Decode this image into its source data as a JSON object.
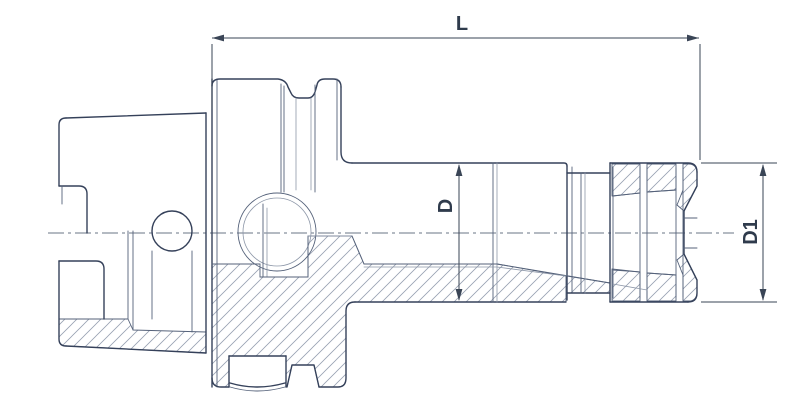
{
  "figure": {
    "type": "technical-drawing",
    "description": "Cross-section side view of an HSK shank collet chuck tool holder with dimension callouts",
    "background": "#ffffff"
  },
  "colors": {
    "outline": "#35415a",
    "detail": "#55627a",
    "thin": "#8d97a8",
    "dimension": "#3a4556",
    "centerline": "#6a7486",
    "hatch": "#98a1b2",
    "label_text": "#2f3b4c"
  },
  "labels": {
    "length": "L",
    "diameter": "D",
    "diameter1": "D1"
  },
  "drawing": {
    "width": 812,
    "height": 408,
    "elements": [
      {
        "name": "hatch-shank-wall",
        "kind": "path",
        "cls": "hatch",
        "d": "M59,319 L128,319 L133,330 L206,332 L206,353 L66,346 Q59,345 59,339 Z"
      },
      {
        "name": "hatch-flange-body",
        "kind": "path",
        "cls": "hatch",
        "d": "M212,264 L260,264 L260,277 L308,277 L308,236 L352,236 L364,264 L497,264 L566,276 L566,302 L354,302 Q346,302 346,311 L346,378 Q346,387 337,387 L319,387 L314,365 L292,365 L287,387 L286,387 L286,356 L229,356 L229,387 L221,387 Q212,387 212,378 Z"
      },
      {
        "name": "hatch-neck",
        "kind": "path",
        "cls": "hatch",
        "d": "M567,276 L610,283 L610,293 L567,293 Z"
      },
      {
        "name": "hatch-nut-top-a",
        "kind": "path",
        "cls": "hatch",
        "d": "M612,164 L640,164 L640,193 L612,196 Z"
      },
      {
        "name": "hatch-nut-top-b",
        "kind": "path",
        "cls": "hatch",
        "d": "M647,164 L676,164 L676,190 L647,192 Z"
      },
      {
        "name": "hatch-nut-top-c",
        "kind": "path",
        "cls": "hatch",
        "d": "M683,164 L689,164 Q696,164 697,172 L697,186 L684,211 L677,205 L683,190 Z"
      },
      {
        "name": "hatch-nut-bottom-a",
        "kind": "path",
        "cls": "hatch",
        "d": "M612,301 L640,301 L640,272 L612,269 Z"
      },
      {
        "name": "hatch-nut-bottom-b",
        "kind": "path",
        "cls": "hatch",
        "d": "M647,301 L676,301 L676,275 L647,273 Z"
      },
      {
        "name": "hatch-nut-bottom-c",
        "kind": "path",
        "cls": "hatch",
        "d": "M683,301 L689,301 Q696,301 697,293 L697,280 L684,254 L677,260 L683,275 Z"
      },
      {
        "name": "centerline",
        "kind": "path",
        "cls": "cl",
        "d": "M48,233 L734,233"
      },
      {
        "name": "shank-top-edge",
        "kind": "path",
        "cls": "ln",
        "d": "M66,118 L206,113"
      },
      {
        "name": "shank-left-edge",
        "kind": "path",
        "cls": "ln",
        "d": "M59,186 L59,125 Q59,118 66,118"
      },
      {
        "name": "shank-notch-step",
        "kind": "path",
        "cls": "ln",
        "d": "M59,186 L79,186 Q87,186 87,194 L87,233"
      },
      {
        "name": "shank-notch-inner",
        "kind": "path",
        "cls": "ln2",
        "d": "M62,186 L62,204"
      },
      {
        "name": "shank-left-lower-edge",
        "kind": "path",
        "cls": "ln",
        "d": "M59,261 L59,339 Q59,346 66,346"
      },
      {
        "name": "shank-bottom-edge",
        "kind": "path",
        "cls": "ln",
        "d": "M66,346 L206,353"
      },
      {
        "name": "shank-bore-block",
        "kind": "path",
        "cls": "ln",
        "d": "M59,261 L96,261 Q104,261 104,269 L104,319"
      },
      {
        "name": "shank-end-face",
        "kind": "path",
        "cls": "ln",
        "d": "M206,113 L206,353"
      },
      {
        "name": "bore-step-line-1",
        "kind": "path",
        "cls": "ln2",
        "d": "M128,231 L128,319"
      },
      {
        "name": "bore-step-line-2",
        "kind": "path",
        "cls": "ln2",
        "d": "M133,231 L133,330"
      },
      {
        "name": "drive-hole-circle",
        "kind": "circle",
        "cls": "ln",
        "cx": 172,
        "cy": 231,
        "r": 20
      },
      {
        "name": "drive-slot-left",
        "kind": "path",
        "cls": "ln2",
        "d": "M152,251 L152,319"
      },
      {
        "name": "drive-slot-right",
        "kind": "path",
        "cls": "ln2",
        "d": "M192,251 L192,332"
      },
      {
        "name": "flange-face-line-1",
        "kind": "path",
        "cls": "ln",
        "d": "M212,79 L212,387"
      },
      {
        "name": "flange-face-line-2",
        "kind": "path",
        "cls": "ln2",
        "d": "M217,79 L217,387"
      },
      {
        "name": "flange-top-profile",
        "kind": "path",
        "cls": "ln",
        "d": "M212,86 Q212,79 220,79 L278,79 Q286,80 288,87 L291,93 Q293,98 299,98 L308,98 Q313,98 315,92 L317,85 Q318,79 325,79 L333,79 Q341,79 341,87"
      },
      {
        "name": "flange-right-edge",
        "kind": "path",
        "cls": "ln",
        "d": "M341,87 L341,152 Q341,163 352,163"
      },
      {
        "name": "flange-right-inner",
        "kind": "path",
        "cls": "ln2",
        "d": "M337,79 L337,160"
      },
      {
        "name": "gripper-rim-edge-1",
        "kind": "path",
        "cls": "ln2",
        "d": "M281,84 L281,192"
      },
      {
        "name": "gripper-rim-edge-2",
        "kind": "path",
        "cls": "ln2",
        "d": "M284,86 L284,192"
      },
      {
        "name": "groove-wall-left",
        "kind": "path",
        "cls": "ln3",
        "d": "M296,98 L296,190"
      },
      {
        "name": "groove-wall-right-1",
        "kind": "path",
        "cls": "ln3",
        "d": "M311,98 L311,190"
      },
      {
        "name": "groove-wall-right-2",
        "kind": "path",
        "cls": "ln2",
        "d": "M315,85 L315,192"
      },
      {
        "name": "coolant-ball-outer",
        "kind": "circle",
        "cls": "ln2",
        "cx": 277,
        "cy": 232,
        "r": 39
      },
      {
        "name": "coolant-ball-inner",
        "kind": "circle",
        "cls": "ln3",
        "cx": 277,
        "cy": 232,
        "r": 34
      },
      {
        "name": "cavity-wall-1",
        "kind": "path",
        "cls": "ln2",
        "d": "M263,204 L263,277"
      },
      {
        "name": "cavity-wall-2",
        "kind": "path",
        "cls": "ln3",
        "d": "M267,208 L267,277"
      },
      {
        "name": "cavity-bottom",
        "kind": "path",
        "cls": "ln2",
        "d": "M260,277 L308,277"
      },
      {
        "name": "cavity-right-wall",
        "kind": "path",
        "cls": "ln2",
        "d": "M308,236 L308,277"
      },
      {
        "name": "cavity-step-line",
        "kind": "path",
        "cls": "ln3",
        "d": "M308,236 L352,236"
      },
      {
        "name": "bore-cone-step",
        "kind": "path",
        "cls": "ln2",
        "d": "M352,236 L364,264"
      },
      {
        "name": "screw-window-left",
        "kind": "path",
        "cls": "ln",
        "d": "M229,356 L229,387"
      },
      {
        "name": "screw-window-right",
        "kind": "path",
        "cls": "ln",
        "d": "M286,356 L286,387"
      },
      {
        "name": "screw-window-top",
        "kind": "path",
        "cls": "ln",
        "d": "M229,356 L286,356"
      },
      {
        "name": "screw-end-arc-1",
        "kind": "path",
        "cls": "ln",
        "d": "M230,383 Q257,391 285,383"
      },
      {
        "name": "screw-end-arc-2",
        "kind": "path",
        "cls": "ln2",
        "d": "M230,387 Q257,395 285,387"
      },
      {
        "name": "flange-bottom-left",
        "kind": "path",
        "cls": "ln",
        "d": "M212,378 Q212,387 221,387 L229,387"
      },
      {
        "name": "flange-bottom-right",
        "kind": "path",
        "cls": "ln",
        "d": "M319,387 L338,387 Q346,387 346,378 L346,311 Q346,302 355,302"
      },
      {
        "name": "orientation-notch",
        "kind": "path",
        "cls": "ln",
        "d": "M287,387 L292,365 L314,365 L319,387"
      },
      {
        "name": "body-top-edge",
        "kind": "path",
        "cls": "ln",
        "d": "M352,163 L564,163 Q567,163 567,166"
      },
      {
        "name": "body-bottom-edge",
        "kind": "path",
        "cls": "ln",
        "d": "M355,302 L566,302"
      },
      {
        "name": "body-front-face-1",
        "kind": "path",
        "cls": "ln",
        "d": "M567,166 L567,300"
      },
      {
        "name": "body-front-face-2",
        "kind": "path",
        "cls": "ln2",
        "d": "M572,167 L572,293"
      },
      {
        "name": "body-step-line-1",
        "kind": "path",
        "cls": "ln2",
        "d": "M493,163 L493,302"
      },
      {
        "name": "body-step-line-2",
        "kind": "path",
        "cls": "ln3",
        "d": "M497,163 L497,302"
      },
      {
        "name": "bore-silhouette-1",
        "kind": "path",
        "cls": "ln2",
        "d": "M364,264 L497,264"
      },
      {
        "name": "bore-silhouette-2",
        "kind": "path",
        "cls": "ln3",
        "d": "M364,267 L497,267"
      },
      {
        "name": "flange-bore-line",
        "kind": "path",
        "cls": "ln2",
        "d": "M212,264 L260,264"
      },
      {
        "name": "collet-cone-line-1",
        "kind": "path",
        "cls": "ln2",
        "d": "M497,264 L610,283"
      },
      {
        "name": "collet-cone-line-2",
        "kind": "path",
        "cls": "ln3",
        "d": "M497,267 L566,276"
      },
      {
        "name": "neck-top-edge",
        "kind": "path",
        "cls": "ln",
        "d": "M567,173 L610,173"
      },
      {
        "name": "neck-bottom-edge",
        "kind": "path",
        "cls": "ln",
        "d": "M567,293 L610,293"
      },
      {
        "name": "neck-detail-1",
        "kind": "path",
        "cls": "ln2",
        "d": "M581,173 L581,293"
      },
      {
        "name": "neck-detail-2",
        "kind": "path",
        "cls": "ln3",
        "d": "M585,173 L585,293"
      },
      {
        "name": "nut-top-edge",
        "kind": "path",
        "cls": "ln",
        "d": "M610,163 L688,163 Q697,163 697,172"
      },
      {
        "name": "nut-front-chamfer-top",
        "kind": "path",
        "cls": "ln",
        "d": "M697,172 L697,186 L684,211"
      },
      {
        "name": "nut-front-face",
        "kind": "path",
        "cls": "ln",
        "d": "M684,211 L684,254"
      },
      {
        "name": "nut-front-chamfer-bottom",
        "kind": "path",
        "cls": "ln",
        "d": "M684,254 L697,280 L697,293 Q697,302 688,302"
      },
      {
        "name": "nut-bottom-edge",
        "kind": "path",
        "cls": "ln",
        "d": "M610,302 L688,302"
      },
      {
        "name": "nut-left-face-1",
        "kind": "path",
        "cls": "ln",
        "d": "M610,163 L610,302"
      },
      {
        "name": "nut-left-face-2",
        "kind": "path",
        "cls": "ln2",
        "d": "M613,167 L613,298"
      },
      {
        "name": "collet-ring-1",
        "kind": "path",
        "cls": "ln2",
        "d": "M640,167 L640,298"
      },
      {
        "name": "collet-ring-2",
        "kind": "path",
        "cls": "ln2",
        "d": "M647,167 L647,298"
      },
      {
        "name": "collet-ring-3",
        "kind": "path",
        "cls": "ln2",
        "d": "M676,168 L676,297"
      },
      {
        "name": "collet-ring-4",
        "kind": "path",
        "cls": "ln2",
        "d": "M683,168 L683,297"
      },
      {
        "name": "nut-wall-inner-top-1",
        "kind": "path",
        "cls": "ln2",
        "d": "M613,196 L640,193"
      },
      {
        "name": "nut-wall-inner-top-2",
        "kind": "path",
        "cls": "ln2",
        "d": "M647,192 L676,190"
      },
      {
        "name": "nut-wall-inner-bottom-1",
        "kind": "path",
        "cls": "ln2",
        "d": "M613,270 L640,272"
      },
      {
        "name": "nut-wall-inner-bottom-2",
        "kind": "path",
        "cls": "ln2",
        "d": "M647,273 L676,275"
      },
      {
        "name": "nut-bore-edge-1",
        "kind": "path",
        "cls": "ln2",
        "d": "M684,218 L697,218"
      },
      {
        "name": "nut-bore-edge-2",
        "kind": "path",
        "cls": "ln2",
        "d": "M684,248 L697,248"
      },
      {
        "name": "collet-cone-in-nut",
        "kind": "path",
        "cls": "ln3",
        "d": "M613,284 L647,290"
      },
      {
        "name": "dim-length-line",
        "kind": "path",
        "cls": "dim",
        "d": "M212,38 L699,38"
      },
      {
        "name": "dim-length-ext-left",
        "kind": "path",
        "cls": "dim",
        "d": "M212,44 L212,109"
      },
      {
        "name": "dim-length-ext-right",
        "kind": "path",
        "cls": "dim",
        "d": "M700,44 L700,160"
      },
      {
        "name": "dim-length-arrow-left",
        "kind": "polygon",
        "cls": "dimfill",
        "points": "212,38 224,34.6 224,41.4"
      },
      {
        "name": "dim-length-arrow-right",
        "kind": "polygon",
        "cls": "dimfill",
        "points": "699,38 687,34.6 687,41.4"
      },
      {
        "name": "dim-diameter-line",
        "kind": "path",
        "cls": "dim",
        "d": "M459,165 L459,300"
      },
      {
        "name": "dim-diameter-arrow-top",
        "kind": "polygon",
        "cls": "dimfill",
        "points": "459,164 455.6,176 462.4,176"
      },
      {
        "name": "dim-diameter-arrow-bottom",
        "kind": "polygon",
        "cls": "dimfill",
        "points": "459,301 455.6,289 462.4,289"
      },
      {
        "name": "dim-diameter1-line",
        "kind": "path",
        "cls": "dim",
        "d": "M763,165 L763,300"
      },
      {
        "name": "dim-diameter1-ext-top",
        "kind": "path",
        "cls": "dim",
        "d": "M701,163 L777,163"
      },
      {
        "name": "dim-diameter1-ext-bottom",
        "kind": "path",
        "cls": "dim",
        "d": "M701,302 L777,302"
      },
      {
        "name": "dim-diameter1-arrow-top",
        "kind": "polygon",
        "cls": "dimfill",
        "points": "763,164 759.6,176 766.4,176"
      },
      {
        "name": "dim-diameter1-arrow-bottom",
        "kind": "polygon",
        "cls": "dimfill",
        "points": "763,301 759.6,289 766.4,289"
      },
      {
        "name": "dim-length-label",
        "kind": "text",
        "cls": "lbl",
        "x": 462,
        "y": 30,
        "bind": "labels.length"
      },
      {
        "name": "dim-diameter-label",
        "kind": "text",
        "cls": "lbl",
        "x": 445,
        "y": 213,
        "transform": "rotate(-90 445 206)",
        "bind": "labels.diameter"
      },
      {
        "name": "dim-diameter1-label",
        "kind": "text",
        "cls": "lbl",
        "x": 750,
        "y": 239,
        "transform": "rotate(-90 750 232)",
        "bind": "labels.diameter1"
      }
    ]
  }
}
